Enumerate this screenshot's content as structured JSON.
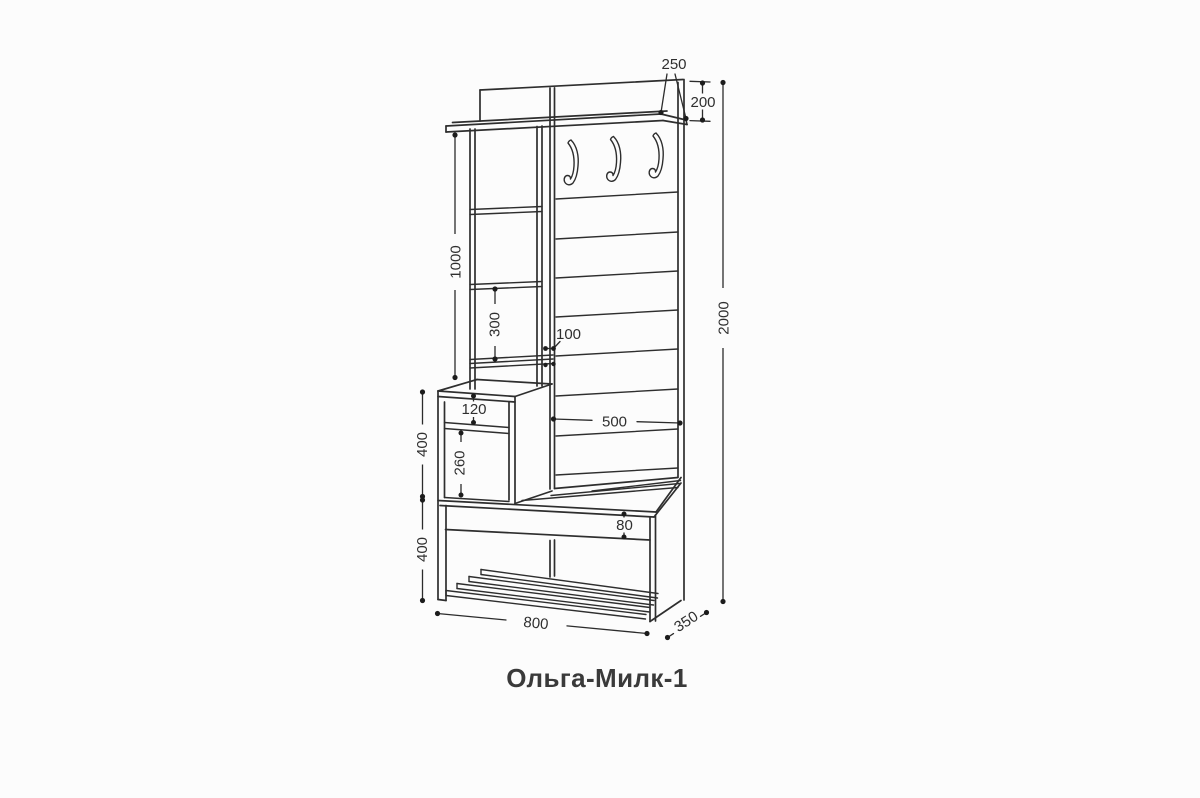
{
  "document": {
    "product_title": "Ольга-Милк-1",
    "background_color": "#fcfcfc",
    "line_color": "#2e2e2e",
    "text_color": "#2f2f2f"
  },
  "dimensions_mm": {
    "shelf_depth": "250",
    "top_panel_height": "200",
    "overall_height": "2000",
    "column_height": "1000",
    "shelf_spacing": "300",
    "divider_depth": "100",
    "hook_panel_width": "500",
    "niche_height": "120",
    "cabinet_opening_height": "260",
    "cabinet_section_height": "400",
    "bench_section_height": "400",
    "seat_apron_height": "80",
    "overall_width": "800",
    "overall_depth": "350"
  }
}
